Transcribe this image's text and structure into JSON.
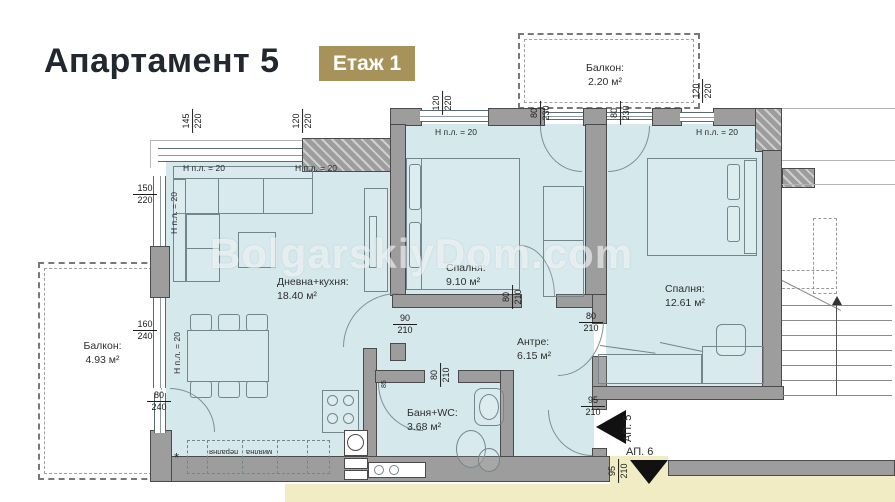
{
  "header": {
    "title": "Апартамент 5",
    "badge": "Етаж 1"
  },
  "watermark": "BolgarskiyDom.com",
  "colors": {
    "accent_gold": "#a7935a",
    "room_fill": "#d5e8ec",
    "wall_fill": "#9d9d9d",
    "neighbor_fill": "#f1ecc3"
  },
  "rooms": {
    "living": {
      "name": "Дневна+кухня:",
      "area": "18.40 м²"
    },
    "bedroom1": {
      "name": "Спалня:",
      "area": "9.10 м²"
    },
    "bedroom2": {
      "name": "Спалня:",
      "area": "12.61 м²"
    },
    "hall": {
      "name": "Антре:",
      "area": "6.15 м²"
    },
    "bath": {
      "name": "Баня+WC:",
      "area": "3.68 м²"
    },
    "balcony_top": {
      "name": "Балкон:",
      "area": "2.20 м²"
    },
    "balcony_left": {
      "name": "Балкон:",
      "area": "4.93 м²"
    }
  },
  "dims": [
    {
      "a": "145",
      "b": "220"
    },
    {
      "a": "120",
      "b": "220"
    },
    {
      "a": "120",
      "b": "220"
    },
    {
      "a": "80",
      "b": "230"
    },
    {
      "a": "80",
      "b": "230"
    },
    {
      "a": "120",
      "b": "220"
    },
    {
      "a": "150",
      "b": "220"
    },
    {
      "a": "160",
      "b": "240"
    },
    {
      "a": "80",
      "b": "240"
    },
    {
      "a": "90",
      "b": "210"
    },
    {
      "a": "80",
      "b": "210"
    },
    {
      "a": "80",
      "b": "210"
    },
    {
      "a": "80",
      "b": "210"
    },
    {
      "a": "95",
      "b": "210"
    },
    {
      "a": "95",
      "b": "210"
    }
  ],
  "height_label": "Н п.л. = 20",
  "annotations": {
    "ap5": "АП. 5",
    "ap6": "АП. 6",
    "door_width": "85",
    "asterisk": "*",
    "kitchen_label_1": "пералня",
    "kitchen_label_2": "миялна"
  }
}
